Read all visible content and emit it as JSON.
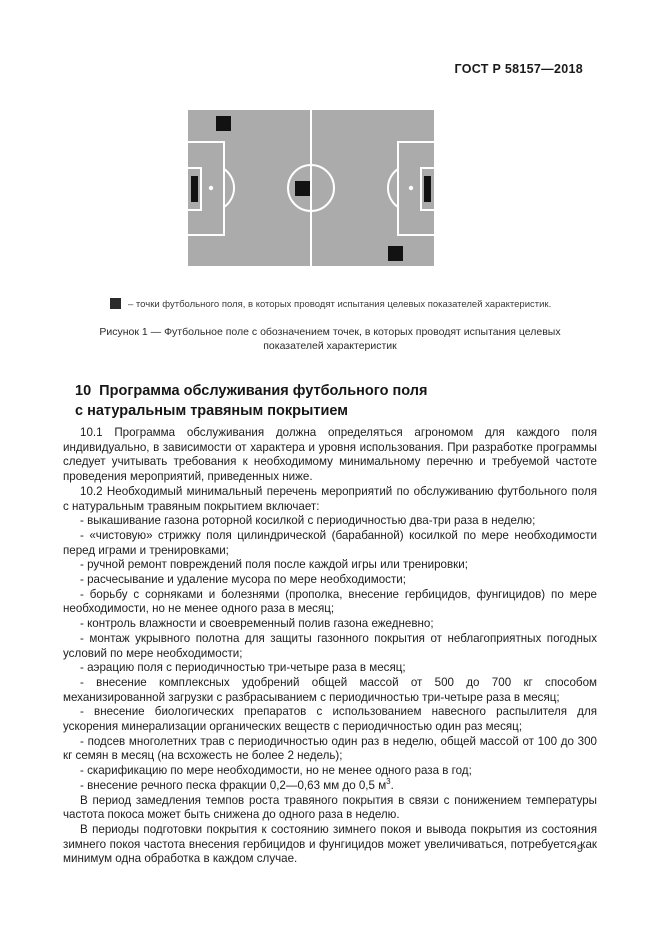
{
  "page": {
    "header": "ГОСТ Р 58157—2018",
    "page_number": "9"
  },
  "figure": {
    "field_color": "#ababab",
    "line_color": "#ffffff",
    "marker_color": "#121212",
    "test_point_positions": [
      "upper-left-quadrant",
      "center-spot",
      "lower-right-quadrant"
    ],
    "legend": "– точки футбольного поля, в которых проводят испытания целевых показателей характеристик.",
    "caption": "Рисунок 1 — Футбольное поле с обозначением точек, в которых проводят испытания целевых показателей характеристик"
  },
  "section": {
    "heading_line1": "10  Программа обслуживания футбольного поля",
    "heading_line2": "с натуральным травяным покрытием",
    "paragraphs": [
      {
        "text": "10.1 Программа обслуживания должна определяться агрономом для каждого поля индивидуально, в зависимости от характера и уровня использования. При разработке программы следует учитывать требования к необходимому минимальному перечню и требуемой частоте проведения мероприятий, приведенных ниже."
      },
      {
        "text": "10.2 Необходимый минимальный перечень мероприятий по обслуживанию футбольного поля с натуральным травяным покрытием включает:"
      },
      {
        "text": "- выкашивание газона роторной косилкой с периодичностью два-три раза в неделю;"
      },
      {
        "text": "- «чистовую» стрижку поля цилиндрической (барабанной) косилкой по мере необходимости перед играми и тренировками;"
      },
      {
        "text": "- ручной ремонт повреждений поля после каждой игры или тренировки;"
      },
      {
        "text": "- расчесывание и удаление мусора по мере необходимости;"
      },
      {
        "text": "- борьбу с сорняками и болезнями (прополка, внесение гербицидов, фунгицидов) по мере необходимости, но не менее одного раза в месяц;"
      },
      {
        "text": "- контроль влажности и своевременный полив газона ежедневно;"
      },
      {
        "text": "- монтаж укрывного полотна для защиты газонного покрытия от неблагоприятных погодных условий по мере необходимости;"
      },
      {
        "text": "- аэрацию поля с периодичностью три-четыре раза в месяц;"
      },
      {
        "text": "- внесение комплексных удобрений общей массой от 500 до 700 кг способом механизированной загрузки с разбрасыванием с периодичностью три-четыре раза в месяц;"
      },
      {
        "text": "- внесение биологических препаратов с использованием навесного распылителя для ускорения минерализации органических веществ с периодичностью один раз месяц;"
      },
      {
        "text": "- подсев многолетних трав с периодичностью один раз в неделю, общей массой от 100 до 300 кг семян в месяц (на всхожесть не более 2 недель);"
      },
      {
        "text": "- скарификацию по мере необходимости, но не менее одного раза в год;"
      },
      {
        "text": "- внесение речного песка фракции 0,2—0,63 мм до 0,5 м",
        "sup": "3",
        "tail": "."
      },
      {
        "text": "В период замедления темпов роста травяного покрытия в связи с понижением температуры частота покоса может быть снижена до одного раза в неделю."
      },
      {
        "text": "В периоды подготовки покрытия к состоянию зимнего покоя и вывода покрытия из состояния зимнего покоя частота внесения гербицидов и фунгицидов может увеличиваться, потребуется как минимум одна обработка в каждом случае."
      }
    ]
  }
}
